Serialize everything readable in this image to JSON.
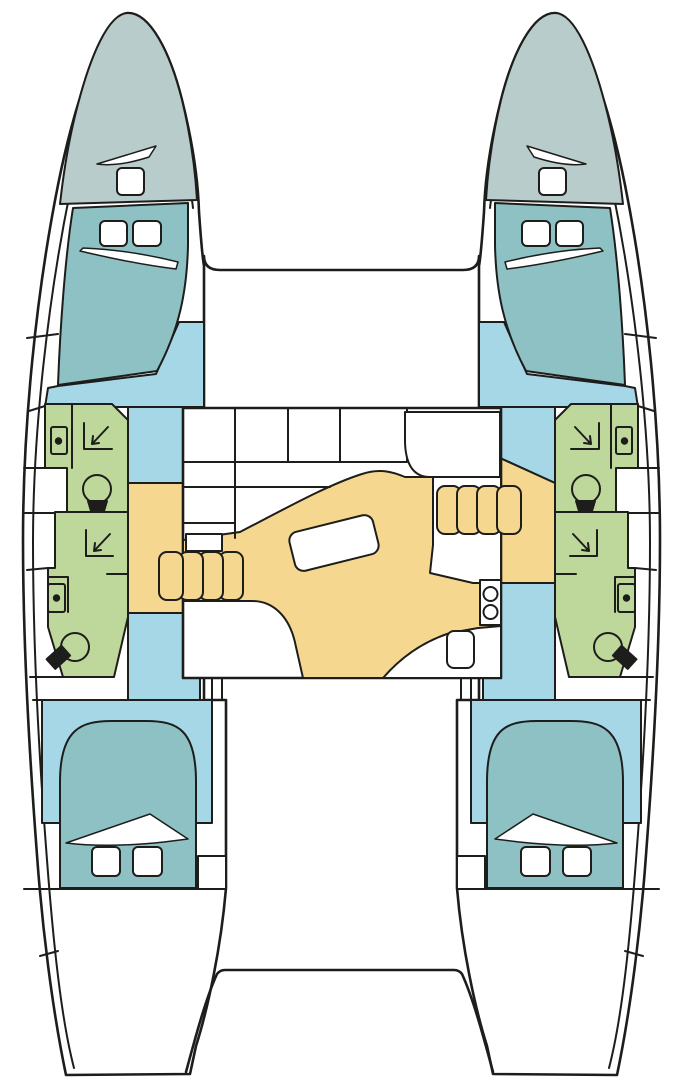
{
  "diagram": {
    "type": "boat-deck-plan",
    "subject": "catamaran interior layout, top-down view, bow up",
    "hull_count": 2,
    "cabins": 4,
    "heads": 4
  },
  "colors": {
    "background": "#ffffff",
    "outline": "#1d1d1b",
    "hull": "#ffffff",
    "foredeck": "#b7cccb",
    "berth": "#8ec1c4",
    "cabin_floor": "#a6d7e7",
    "head_compartment": "#bed79b",
    "saloon_floor": "#f5d78f",
    "fixture": "#ffffff"
  },
  "legend": [
    {
      "area": "foredeck-locker",
      "color": "#b7cccb"
    },
    {
      "area": "berths",
      "color": "#8ec1c4"
    },
    {
      "area": "cabin-floor",
      "color": "#a6d7e7"
    },
    {
      "area": "head-compartments",
      "color": "#bed79b"
    },
    {
      "area": "saloon-floor-and-stairs",
      "color": "#f5d78f"
    },
    {
      "area": "deck-and-fixtures",
      "color": "#ffffff"
    }
  ],
  "regions": {
    "port_hull": [
      "foredeck",
      "forward-cabin",
      "forward-head",
      "aft-head",
      "companionway",
      "aft-cabin",
      "transom"
    ],
    "starboard_hull": [
      "foredeck",
      "forward-cabin",
      "forward-head",
      "aft-head",
      "companionway",
      "aft-cabin",
      "transom"
    ],
    "bridgedeck": [
      "saloon-settee",
      "saloon-table",
      "chart-area",
      "galley-counter",
      "stove",
      "galley-sink",
      "port-stairs",
      "starboard-stairs",
      "cockpit"
    ]
  },
  "symbols": [
    "hatch",
    "window",
    "shower",
    "toilet",
    "sink",
    "stove-burner",
    "table",
    "stairs"
  ]
}
